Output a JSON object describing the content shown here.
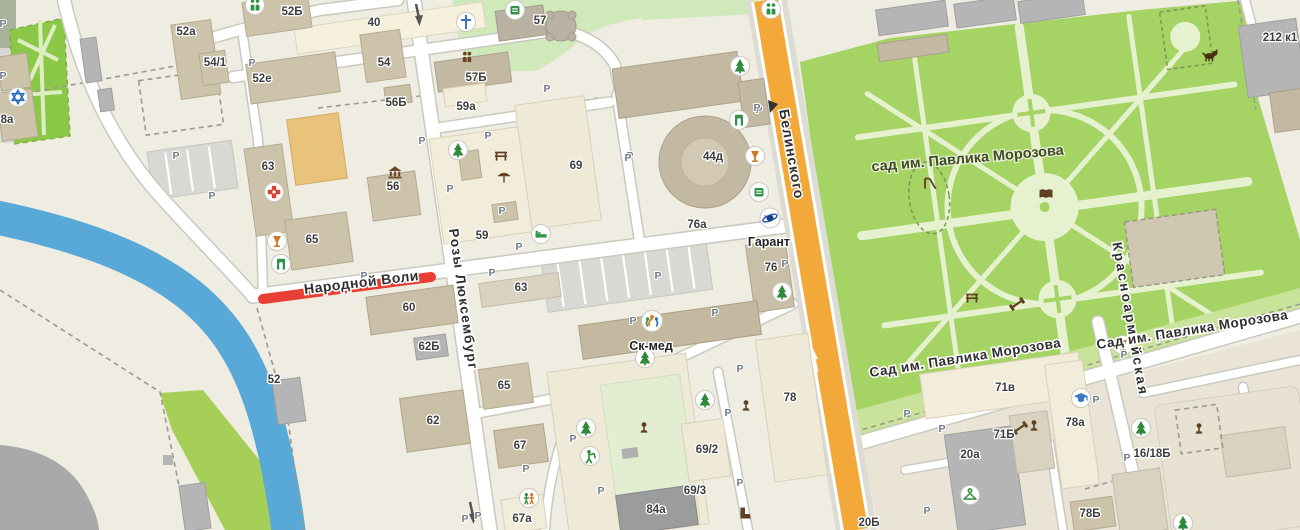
{
  "map_type": "city-map",
  "colors": {
    "background": "#efece1",
    "river": "#58a8d8",
    "park_green": "#a5d364",
    "park_path": "#e6f2cf",
    "main_road": "#f3a93a",
    "closed_road": "#e93e34",
    "building_tan": "#cdc3ab"
  },
  "park": {
    "label": "сад  им. Павлика Морозова",
    "x": 968,
    "y": 163,
    "rot": -5
  },
  "street_labels": [
    {
      "text": "Народной Воли",
      "x": 362,
      "y": 287,
      "rot": -7,
      "size": 14,
      "ls": 0.5,
      "anchor": "middle"
    },
    {
      "text": "Розы Люксембург",
      "x": 459,
      "y": 300,
      "rot": 82,
      "size": 13.5,
      "ls": 1.5,
      "anchor": "middle"
    },
    {
      "text": "Белинского",
      "x": 787,
      "y": 155,
      "rot": 80,
      "size": 14,
      "ls": 1,
      "anchor": "middle"
    },
    {
      "text": "Красноармейская",
      "x": 1126,
      "y": 320,
      "rot": 80,
      "size": 13.5,
      "ls": 2.5,
      "anchor": "start"
    },
    {
      "text": "Сад им. Павлика Морозова",
      "x": 966,
      "y": 362,
      "rot": -9,
      "size": 13.5,
      "ls": 0.5,
      "anchor": "middle"
    },
    {
      "text": "Сад им. Павлика Морозова",
      "x": 1193,
      "y": 334,
      "rot": -9,
      "size": 13.5,
      "ls": 0.5,
      "anchor": "start"
    }
  ],
  "poi_labels": [
    {
      "text": "Гарант",
      "x": 769,
      "y": 242
    },
    {
      "text": "Ск-мед",
      "x": 651,
      "y": 346
    }
  ],
  "building_labels": [
    {
      "text": "40",
      "x": 374,
      "y": 22
    },
    {
      "text": "52а",
      "x": 186,
      "y": 31
    },
    {
      "text": "54/1",
      "x": 215,
      "y": 62
    },
    {
      "text": "52е",
      "x": 262,
      "y": 78
    },
    {
      "text": "52Б",
      "x": 292,
      "y": 11
    },
    {
      "text": "54",
      "x": 384,
      "y": 62
    },
    {
      "text": "56Б",
      "x": 396,
      "y": 102
    },
    {
      "text": "57Б",
      "x": 476,
      "y": 77
    },
    {
      "text": "59а",
      "x": 466,
      "y": 106
    },
    {
      "text": "57",
      "x": 540,
      "y": 20
    },
    {
      "text": "69",
      "x": 576,
      "y": 165
    },
    {
      "text": "44д",
      "x": 713,
      "y": 156
    },
    {
      "text": "63",
      "x": 268,
      "y": 166
    },
    {
      "text": "56",
      "x": 393,
      "y": 186
    },
    {
      "text": "65",
      "x": 312,
      "y": 239
    },
    {
      "text": "59",
      "x": 482,
      "y": 235
    },
    {
      "text": "63",
      "x": 521,
      "y": 287
    },
    {
      "text": "60",
      "x": 409,
      "y": 307
    },
    {
      "text": "62Б",
      "x": 429,
      "y": 346
    },
    {
      "text": "52",
      "x": 274,
      "y": 379
    },
    {
      "text": "65",
      "x": 504,
      "y": 385
    },
    {
      "text": "62",
      "x": 433,
      "y": 420
    },
    {
      "text": "67",
      "x": 520,
      "y": 445
    },
    {
      "text": "67а",
      "x": 522,
      "y": 518
    },
    {
      "text": "84а",
      "x": 656,
      "y": 509
    },
    {
      "text": "69/2",
      "x": 707,
      "y": 449
    },
    {
      "text": "69/3",
      "x": 695,
      "y": 490
    },
    {
      "text": "78",
      "x": 790,
      "y": 397
    },
    {
      "text": "76а",
      "x": 697,
      "y": 224
    },
    {
      "text": "76",
      "x": 771,
      "y": 267
    },
    {
      "text": "71в",
      "x": 1005,
      "y": 387
    },
    {
      "text": "71Б",
      "x": 1004,
      "y": 434
    },
    {
      "text": "20а",
      "x": 970,
      "y": 454
    },
    {
      "text": "78а",
      "x": 1075,
      "y": 422
    },
    {
      "text": "16/18Б",
      "x": 1152,
      "y": 453
    },
    {
      "text": "78Б",
      "x": 1090,
      "y": 513
    },
    {
      "text": "20Б",
      "x": 869,
      "y": 522
    },
    {
      "text": "212 к1",
      "x": 1280,
      "y": 37
    },
    {
      "text": "8а",
      "x": 7,
      "y": 119
    }
  ],
  "parking": {
    "letter": "Р",
    "positions": [
      [
        3,
        23
      ],
      [
        3,
        75
      ],
      [
        252,
        62
      ],
      [
        176,
        155
      ],
      [
        212,
        195
      ],
      [
        364,
        275
      ],
      [
        492,
        272
      ],
      [
        519,
        246
      ],
      [
        488,
        135
      ],
      [
        450,
        188
      ],
      [
        502,
        210
      ],
      [
        630,
        155
      ],
      [
        658,
        275
      ],
      [
        547,
        88
      ],
      [
        422,
        140
      ],
      [
        759,
        109
      ],
      [
        628,
        157
      ],
      [
        757,
        107
      ],
      [
        785,
        263
      ],
      [
        715,
        312
      ],
      [
        740,
        368
      ],
      [
        728,
        412
      ],
      [
        526,
        468
      ],
      [
        465,
        518
      ],
      [
        633,
        320
      ],
      [
        1096,
        399
      ],
      [
        907,
        413
      ],
      [
        942,
        428
      ],
      [
        1124,
        354
      ],
      [
        1160,
        338
      ],
      [
        927,
        510
      ],
      [
        1127,
        457
      ],
      [
        573,
        438
      ],
      [
        601,
        490
      ],
      [
        740,
        482
      ],
      [
        478,
        515
      ]
    ]
  },
  "icons": [
    {
      "type": "star",
      "x": 18,
      "y": 97
    },
    {
      "type": "people2",
      "x": 255,
      "y": 5
    },
    {
      "type": "people2",
      "x": 771,
      "y": 9
    },
    {
      "type": "church",
      "x": 466,
      "y": 22
    },
    {
      "type": "peoplesm",
      "x": 467,
      "y": 57
    },
    {
      "type": "medical",
      "x": 274,
      "y": 192
    },
    {
      "type": "wine",
      "x": 277,
      "y": 241
    },
    {
      "type": "door",
      "x": 281,
      "y": 264
    },
    {
      "type": "atm",
      "x": 515,
      "y": 10
    },
    {
      "type": "tree",
      "x": 740,
      "y": 66
    },
    {
      "type": "door",
      "x": 739,
      "y": 120
    },
    {
      "type": "wine",
      "x": 755,
      "y": 156
    },
    {
      "type": "atm",
      "x": 759,
      "y": 192
    },
    {
      "type": "tree",
      "x": 782,
      "y": 292
    },
    {
      "type": "tree",
      "x": 458,
      "y": 150
    },
    {
      "type": "bench",
      "x": 501,
      "y": 155
    },
    {
      "type": "umbrella",
      "x": 504,
      "y": 176
    },
    {
      "type": "bank",
      "x": 395,
      "y": 171
    },
    {
      "type": "bed",
      "x": 541,
      "y": 234
    },
    {
      "type": "garant",
      "x": 770,
      "y": 218
    },
    {
      "type": "skmed",
      "x": 652,
      "y": 321
    },
    {
      "type": "tree",
      "x": 586,
      "y": 428
    },
    {
      "type": "tree",
      "x": 645,
      "y": 358
    },
    {
      "type": "tree",
      "x": 705,
      "y": 400
    },
    {
      "type": "golf",
      "x": 590,
      "y": 456
    },
    {
      "type": "monument",
      "x": 644,
      "y": 428
    },
    {
      "type": "monument",
      "x": 746,
      "y": 406
    },
    {
      "type": "kids",
      "x": 529,
      "y": 498
    },
    {
      "type": "boot",
      "x": 744,
      "y": 513
    },
    {
      "type": "grad",
      "x": 1081,
      "y": 398
    },
    {
      "type": "wine",
      "x": 1123,
      "y": 345
    },
    {
      "type": "dumbbell",
      "x": 1020,
      "y": 428
    },
    {
      "type": "monument",
      "x": 1034,
      "y": 426
    },
    {
      "type": "hanger",
      "x": 970,
      "y": 495
    },
    {
      "type": "tree",
      "x": 1141,
      "y": 428
    },
    {
      "type": "monument",
      "x": 1199,
      "y": 429
    },
    {
      "type": "dog",
      "x": 1210,
      "y": 55
    },
    {
      "type": "slide",
      "x": 929,
      "y": 182
    },
    {
      "type": "book",
      "x": 1046,
      "y": 193
    },
    {
      "type": "bench",
      "x": 972,
      "y": 297
    },
    {
      "type": "dumbbell",
      "x": 1017,
      "y": 304
    },
    {
      "type": "tree",
      "x": 1183,
      "y": 523
    }
  ]
}
